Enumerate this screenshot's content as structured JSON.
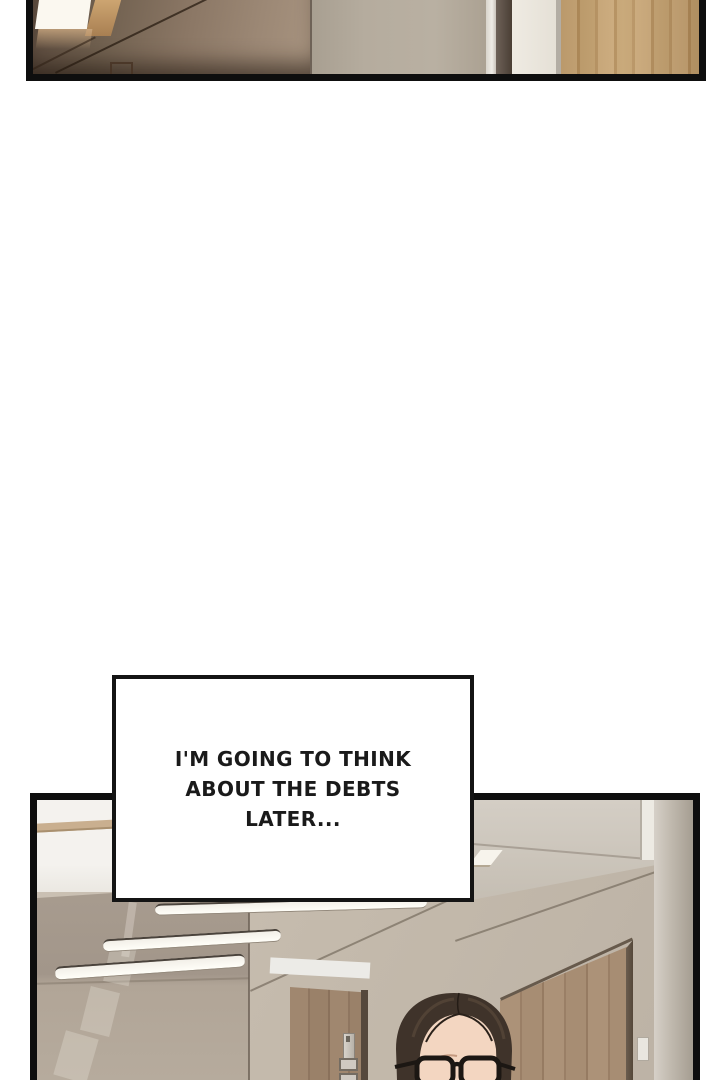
{
  "page": {
    "width": 720,
    "height": 1080,
    "background": "#ffffff",
    "type": "webtoon comic page"
  },
  "speech_bubble": {
    "lines": [
      "I'M GOING TO THINK",
      "ABOUT THE DEBTS",
      "LATER..."
    ],
    "full_text": "I'M GOING TO THINK ABOUT THE DEBTS LATER...",
    "fill": "#ffffff",
    "border_color": "#141414",
    "text_color": "#1a1a1a"
  },
  "panels": {
    "top": {
      "description": "Cropped strip of an office interior: glowing ceiling light reflected in a dark brown glass partition, beige plaster wall, white door frame strip and a light oak wooden door."
    },
    "bottom": {
      "description": "Office hallway seen from above: taupe glass partition reflecting three recessed linear ceiling lights, beige ceiling planes, wooden doors, a wall switch panel, and a dark-haired man with black glasses entering from the bottom edge."
    }
  },
  "character": {
    "name": "man with glasses",
    "hair_color": "#3f332a",
    "skin_color": "#f3d6c1",
    "glasses_color": "#1c1713"
  },
  "palette": {
    "panel_border": "#0e0e0e",
    "glass_brown": "#7b685a",
    "wall_beige": "#b6ad9f",
    "wood_light": "#c7a576",
    "wood_door": "#a78d73",
    "ceiling_taupe": "#a89c8f",
    "hall_beige": "#c3b9ab",
    "light_strip": "#fffef8"
  }
}
